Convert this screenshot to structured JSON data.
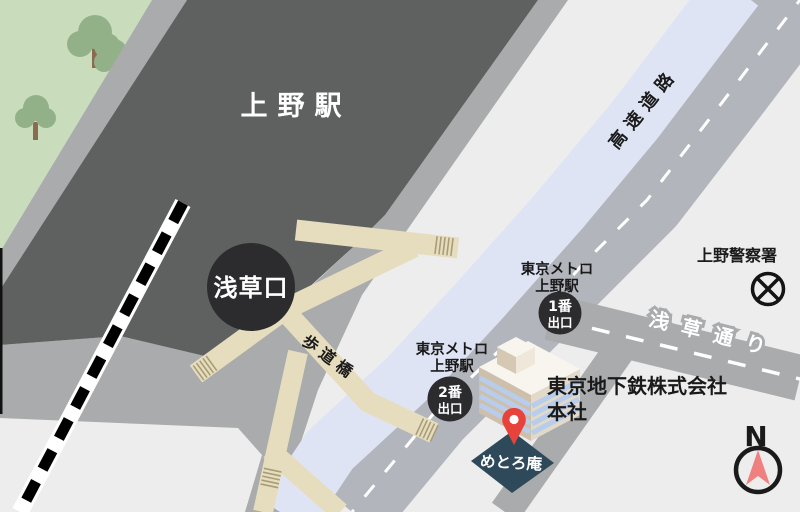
{
  "labels": {
    "station": "上野駅",
    "asakusa_exit": "浅草口",
    "footbridge": "歩道橋",
    "expressway": "高速道路",
    "asakusa_street": "浅草通り",
    "police_station": "上野警察署",
    "metro_exit1": {
      "station_line1": "東京メトロ",
      "station_line2": "上野駅",
      "badge_line1": "1番",
      "badge_line2": "出口"
    },
    "metro_exit2": {
      "station_line1": "東京メトロ",
      "station_line2": "上野駅",
      "badge_line1": "2番",
      "badge_line2": "出口"
    },
    "hq_line1": "東京地下鉄株式会社",
    "hq_line2": "本社",
    "destination": "めとろ庵",
    "compass_north": "N"
  },
  "colors": {
    "background": "#ededed",
    "park": "#c9ddbd",
    "tree_canopy": "#93b189",
    "tree_trunk": "#8b6b4f",
    "road": "#a9abac",
    "dashed_road": "#b3b5bc",
    "station_area": "#5f6060",
    "exit_circle": "#2c2c2e",
    "expressway": "#dfe4f4",
    "walkway": "#e6ddbf",
    "stair": "#a89d77",
    "railway_band": "#ffffff",
    "railway_dash": "#000000",
    "building_roof": "#f7f5ee",
    "building_left": "#cdbfaa",
    "building_right": "#e3d9c9",
    "building_stripe": "#b7cdeb",
    "destination_marker": "#2e4a5a",
    "pin": "#e8433a",
    "compass_needle": "#f08080",
    "label_text": "#1a1a1a",
    "label_text_white": "#ffffff"
  }
}
